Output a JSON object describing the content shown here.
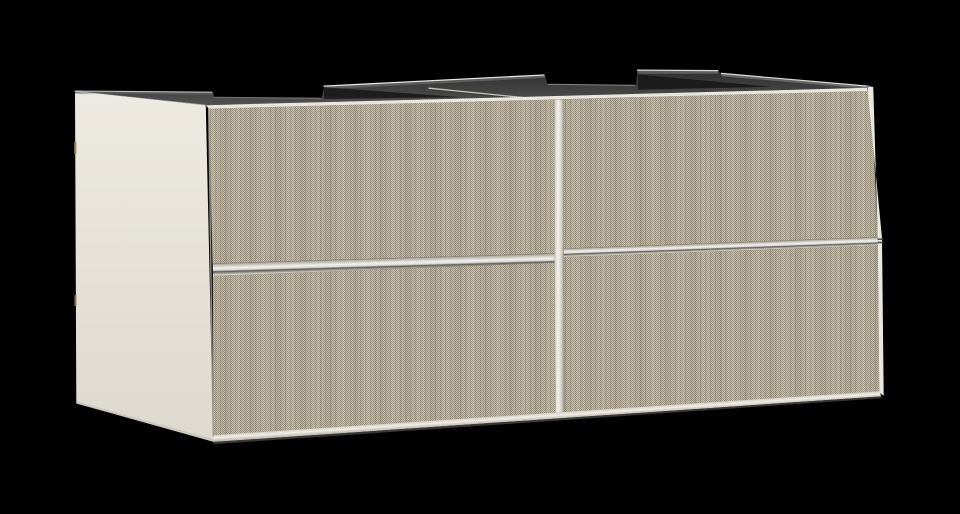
{
  "scene": {
    "label": "Wall-mounted double vanity cabinet with four textured drawer fronts, viewed from front-left on black background",
    "background": "#000000"
  },
  "colors": {
    "side_panel_top": "#edeae2",
    "side_panel_bottom": "#ddd9cf",
    "panel_bottom_edge": "#c2bfb5",
    "top_surface_back": "#2e2e2e",
    "top_surface_front": "#565656",
    "top_back_rail": "#5d5d5d",
    "top_right_sliver": "#707070",
    "notch_shadow": "#161616",
    "edge_highlight": "#f2f2ec",
    "texture_light": "#c6bfac",
    "texture_dark": "#99917e",
    "texture_stripe": "#3c3628",
    "texture_band_light": "#fffdf5",
    "texture_band_dark": "#000000",
    "front_strip": "#e9e6de",
    "bottom_strip_top": "#cfccc2",
    "bottom_strip_mid": "#efede6",
    "bottom_strip_bottom": "#b1aea4",
    "under_shadow": "#44423d",
    "handle_shadow_top": "#7a766a",
    "handle_mid1": "#b2afa5",
    "handle_bright": "#f0f0ec",
    "handle_mid2": "#d8d8d4",
    "handle_dark_seam": "#5e5b52",
    "handle_mid3": "#8f8c82",
    "handle_end": "#d2cfc5",
    "divider_edge": "#8f8c83",
    "divider_light": "#dcdad2",
    "divider_bright": "#f1efe9",
    "divider_mid": "#d2cfc6",
    "divider_edge2": "#8a877e",
    "divider_top_line": "#ccc9bf",
    "divider_top_dark": "#3b3b39",
    "seam": "#a5a299",
    "cap_dark": "#3f3d38",
    "rear_sliver_tan": "#9a8455",
    "artifact_blue": "#5565b5"
  }
}
